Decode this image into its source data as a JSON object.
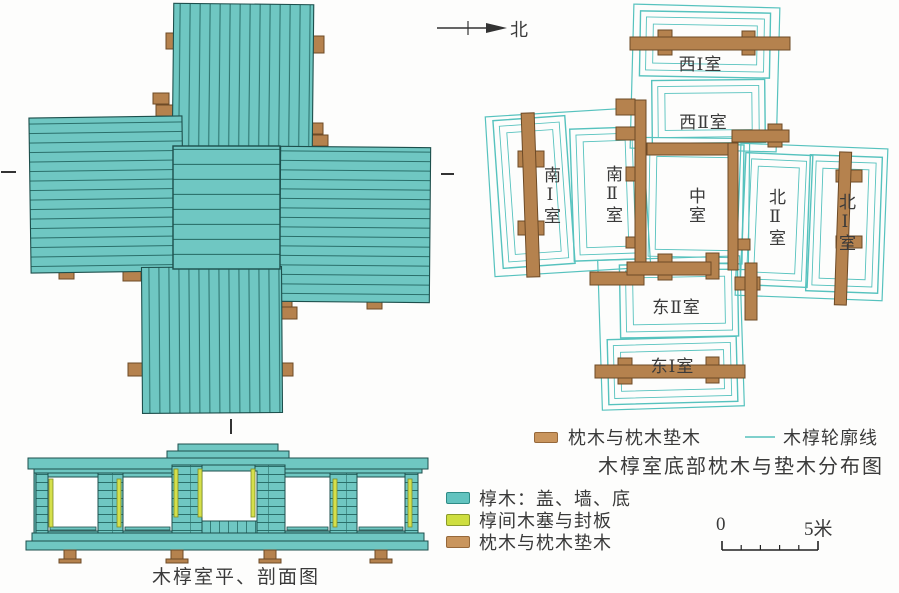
{
  "north": {
    "label": "北"
  },
  "plan": {
    "caption": "木椁室平、剖面图"
  },
  "distribution": {
    "title": "木椁室底部枕木与垫木分布图",
    "rooms": [
      {
        "key": "west1",
        "label": "西Ⅰ室"
      },
      {
        "key": "west2",
        "label": "西Ⅱ室"
      },
      {
        "key": "south1",
        "label": "南Ⅰ室"
      },
      {
        "key": "south2",
        "label": "南Ⅱ室"
      },
      {
        "key": "center",
        "label": "中室"
      },
      {
        "key": "north2",
        "label": "北Ⅱ室"
      },
      {
        "key": "north1",
        "label": "北Ⅰ室"
      },
      {
        "key": "east2",
        "label": "东Ⅱ室"
      },
      {
        "key": "east1",
        "label": "东Ⅰ室"
      }
    ],
    "legend": [
      {
        "swatch": "brown-bar",
        "label": "枕木与枕木垫木"
      },
      {
        "swatch": "teal-line",
        "label": "木椁轮廓线"
      }
    ]
  },
  "legend_main": {
    "items": [
      {
        "swatch": "teal",
        "label": "椁木：盖、墙、底"
      },
      {
        "swatch": "yellow",
        "label": "椁间木塞与封板"
      },
      {
        "swatch": "brown",
        "label": "枕木与枕木垫木"
      }
    ]
  },
  "scale_bar": {
    "start": "0",
    "end": "5米"
  },
  "colors": {
    "chamber_teal": "#6FC7C2",
    "outline_teal": "#56C2BE",
    "sleeper_brown": "#B5824E",
    "plug_yellow": "#D5E04B"
  }
}
